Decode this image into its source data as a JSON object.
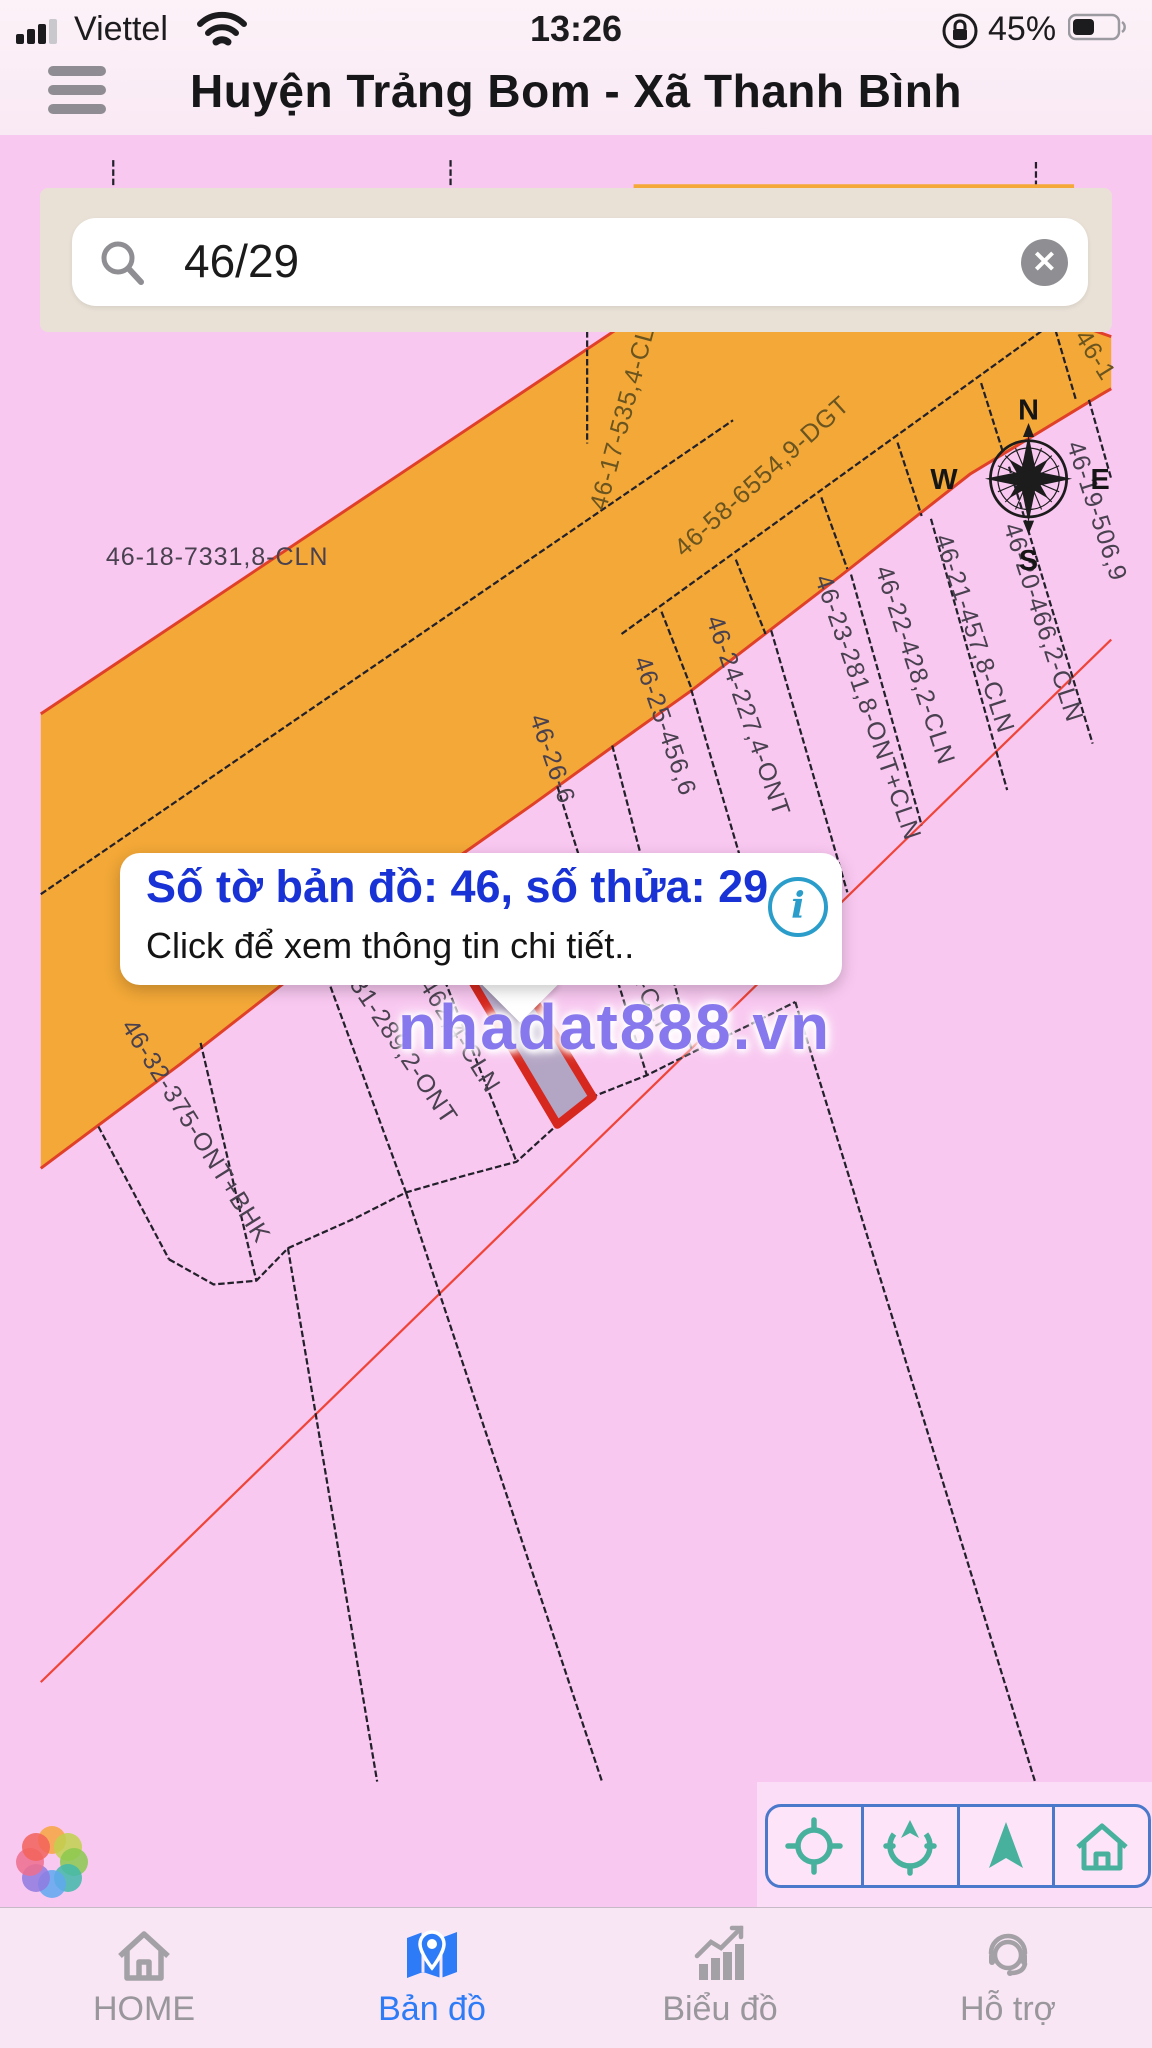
{
  "status_bar": {
    "carrier": "Viettel",
    "time": "13:26",
    "battery_percent": "45%"
  },
  "header": {
    "title": "Huyện Trảng Bom - Xã Thanh Bình"
  },
  "search": {
    "value": "46/29"
  },
  "popup": {
    "title": "Số tờ bản đồ: 46, số thửa: 29",
    "subtitle": "Click để xem thông tin chi tiết..",
    "info_glyph": "i"
  },
  "watermark": {
    "text": "nhadat888.vn"
  },
  "map": {
    "compass": {
      "n": "N",
      "e": "E",
      "s": "S",
      "w": "W"
    },
    "labels": [
      {
        "text": "46-18-7331,8-CLN"
      },
      {
        "text": "46-17-535,4-CL"
      },
      {
        "text": "46-58-6554,9-DGT"
      },
      {
        "text": "46-1"
      },
      {
        "text": "46-19-506,9"
      },
      {
        "text": "46-20-466,2-CLN"
      },
      {
        "text": "46-21-457,8-CLN"
      },
      {
        "text": "46-22-428,2-CLN"
      },
      {
        "text": "46-23-281,8-ONT+CLN"
      },
      {
        "text": "46-24-227,4-ONT"
      },
      {
        "text": "46-25-456,6"
      },
      {
        "text": "46-26-6"
      },
      {
        "text": "7-ONT"
      },
      {
        "text": "-ONT+CLN"
      },
      {
        "text": "-ONT"
      },
      {
        "text": "46-30-462,4-CLN"
      },
      {
        "text": "46-31-289,2-ONT"
      },
      {
        "text": "46-32-375-ONT+BHK"
      }
    ],
    "colors": {
      "parcel_pink": "#f9c8f1",
      "road_orange": "#f3a837",
      "boundary_red": "#e04028",
      "selected_fill": "#b3a5c4",
      "selected_stroke": "#d6281e"
    }
  },
  "controls": {
    "buttons": [
      {
        "name": "locate"
      },
      {
        "name": "compass"
      },
      {
        "name": "navigate"
      },
      {
        "name": "home"
      }
    ]
  },
  "tab_bar": {
    "active_color": "#2d7bf7",
    "tabs": [
      {
        "label": "HOME",
        "active": false
      },
      {
        "label": "Bản đồ",
        "active": true
      },
      {
        "label": "Biểu đồ",
        "active": false
      },
      {
        "label": "Hỗ trợ",
        "active": false
      }
    ]
  }
}
